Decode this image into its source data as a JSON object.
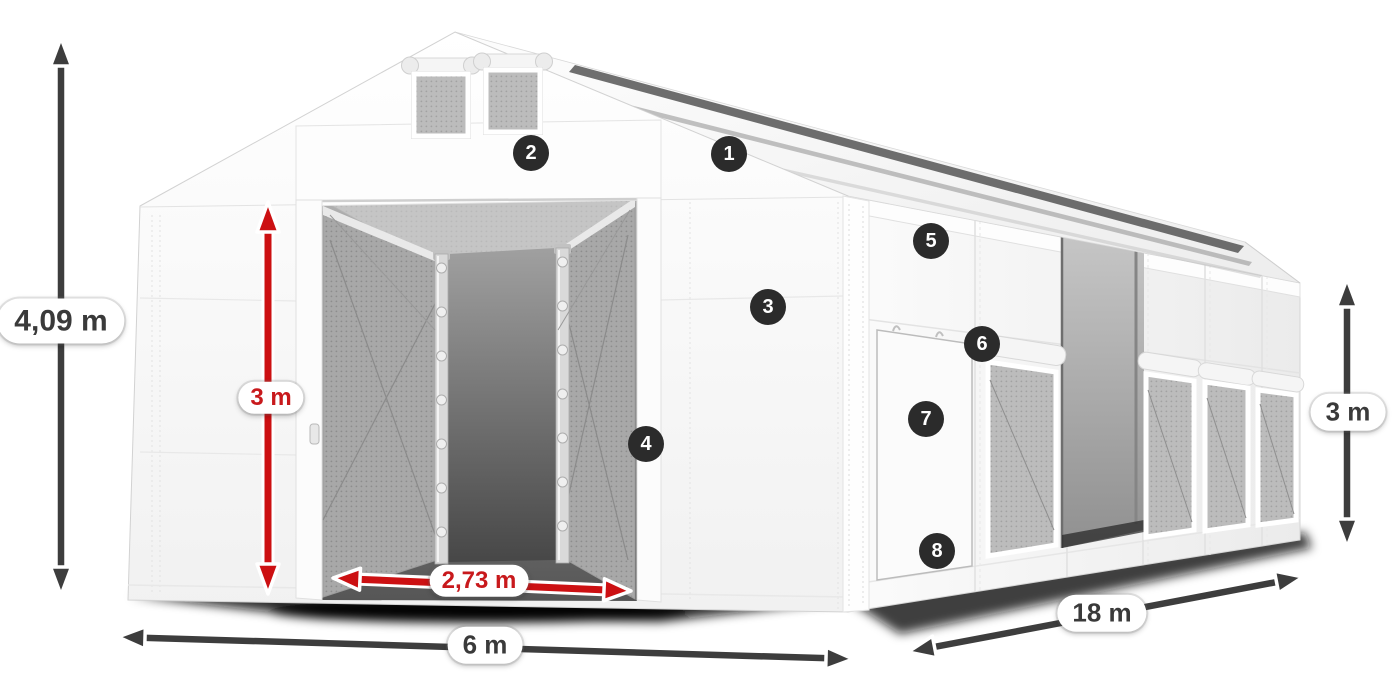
{
  "page": {
    "background": "#ffffff"
  },
  "diagram": {
    "subject": "storage tent with dimension callouts"
  },
  "dimensions": {
    "total_height": {
      "value": "4,09 m",
      "style": "dark",
      "orientation": "vertical-left"
    },
    "door_height": {
      "value": "3 m",
      "style": "red",
      "orientation": "vertical-door"
    },
    "door_width": {
      "value": "2,73 m",
      "style": "red",
      "orientation": "horizontal-door"
    },
    "front_width": {
      "value": "6 m",
      "style": "dark",
      "orientation": "horizontal-front"
    },
    "side_length": {
      "value": "18 m",
      "style": "dark",
      "orientation": "diagonal-side"
    },
    "side_height": {
      "value": "3 m",
      "style": "dark",
      "orientation": "vertical-right"
    }
  },
  "markers": [
    {
      "number": "1"
    },
    {
      "number": "2"
    },
    {
      "number": "3"
    },
    {
      "number": "4"
    },
    {
      "number": "5"
    },
    {
      "number": "6"
    },
    {
      "number": "7"
    },
    {
      "number": "8"
    }
  ],
  "colors": {
    "arrow_dark": "#3d3d3d",
    "arrow_red": "#cc1012",
    "label_dark": "#3a3a3a",
    "label_red": "#c8191c",
    "marker_background": "#2b2b2b",
    "marker_number": "#ffffff",
    "tent_white": "#ffffff",
    "mesh_gray": "#b3b3b3"
  }
}
